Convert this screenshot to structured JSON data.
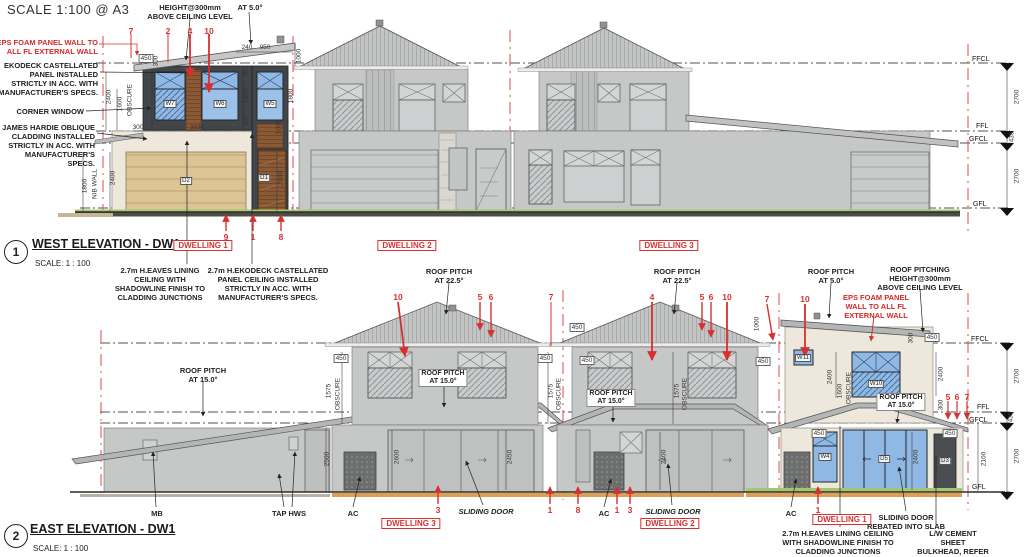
{
  "header": {
    "scale_note": "SCALE 1:100  @ A3"
  },
  "colors": {
    "annotation_red": "#d63030",
    "window_blue": "#8fb9e4",
    "timber_brown": "#8a5a36",
    "garage_tan": "#dcc496",
    "wall_gray": "#c6c8c7",
    "wall_cream": "#ede8db",
    "panel_charcoal": "#42464a",
    "grass_green": "#a5c86e",
    "deck_orange": "#dd9f56"
  },
  "west": {
    "drawing_number": "1",
    "title": "WEST ELEVATION - DW1",
    "scale": "SCALE:  1 : 100",
    "annotations": [
      {
        "t": "HEIGHT@300mm\nABOVE CEILING LEVEL",
        "c": "note",
        "x": 190,
        "y": 3
      },
      {
        "t": "AT 5.0°",
        "c": "note",
        "x": 250,
        "y": 3
      },
      {
        "t": "7",
        "c": "red",
        "x": 131,
        "y": 26
      },
      {
        "t": "2",
        "c": "red",
        "x": 168,
        "y": 26
      },
      {
        "t": "4",
        "c": "red",
        "x": 190,
        "y": 26
      },
      {
        "t": "10",
        "c": "red",
        "x": 209,
        "y": 26
      },
      {
        "t": "EPS FOAM PANEL WALL TO\nALL FL EXTERNAL WALL",
        "c": "noteR red2",
        "x": 98,
        "y": 38
      },
      {
        "t": "EKODECK CASTELLATED\nPANEL INSTALLED\nSTRICTLY IN ACC. WITH\nMANUFACTURER'S SPECS.",
        "c": "noteR",
        "x": 98,
        "y": 61
      },
      {
        "t": "CORNER WINDOW",
        "c": "noteR",
        "x": 84,
        "y": 107
      },
      {
        "t": "JAMES HARDIE OBLIQUE\nCLADDING INSTALLED\nSTRICTLY IN ACC. WITH\nMANUFACTURER'S\nSPECS.",
        "c": "noteR",
        "x": 95,
        "y": 123
      },
      {
        "t": "450",
        "c": "dimbox",
        "x": 146,
        "y": 54
      },
      {
        "t": "300",
        "c": "dimv",
        "x": 156,
        "y": 61
      },
      {
        "t": "240",
        "c": "dim",
        "x": 247,
        "y": 44
      },
      {
        "t": "950",
        "c": "dim",
        "x": 265,
        "y": 44
      },
      {
        "t": "1000",
        "c": "dimv",
        "x": 299,
        "y": 56
      },
      {
        "t": "2400",
        "c": "dimv",
        "x": 109,
        "y": 97
      },
      {
        "t": "1600",
        "c": "dimv",
        "x": 120,
        "y": 104
      },
      {
        "t": "OBSCURE",
        "c": "dimv",
        "x": 130,
        "y": 100
      },
      {
        "t": "300",
        "c": "dimv",
        "x": 246,
        "y": 71
      },
      {
        "t": "1800",
        "c": "dimv",
        "x": 246,
        "y": 96
      },
      {
        "t": "300",
        "c": "dimv",
        "x": 246,
        "y": 121
      },
      {
        "t": "1800",
        "c": "dimv",
        "x": 291,
        "y": 96
      },
      {
        "t": "1035",
        "c": "dimv",
        "x": 279,
        "y": 127
      },
      {
        "t": "300",
        "c": "dim",
        "x": 138,
        "y": 124
      },
      {
        "t": "3830",
        "c": "dim",
        "x": 197,
        "y": 124
      },
      {
        "t": "W7",
        "c": "wlbl",
        "x": 170,
        "y": 104
      },
      {
        "t": "W6",
        "c": "wlbl",
        "x": 220,
        "y": 104
      },
      {
        "t": "W5",
        "c": "wlbl",
        "x": 270,
        "y": 104
      },
      {
        "t": "D2",
        "c": "wlbl",
        "x": 186,
        "y": 181
      },
      {
        "t": "D1",
        "c": "wlbl",
        "x": 264,
        "y": 178
      },
      {
        "t": "2400",
        "c": "dimv",
        "x": 281,
        "y": 178
      },
      {
        "t": "1800",
        "c": "dimv",
        "x": 85,
        "y": 186
      },
      {
        "t": "NIB WALL",
        "c": "dimv",
        "x": 95,
        "y": 184
      },
      {
        "t": "2400",
        "c": "dimv",
        "x": 113,
        "y": 178
      },
      {
        "t": "9",
        "c": "red",
        "x": 226,
        "y": 232
      },
      {
        "t": "1",
        "c": "red",
        "x": 253,
        "y": 232
      },
      {
        "t": "8",
        "c": "red",
        "x": 281,
        "y": 232
      },
      {
        "t": "DWELLING 1",
        "c": "redbox",
        "x": 203,
        "y": 240
      },
      {
        "t": "DWELLING 2",
        "c": "redbox",
        "x": 407,
        "y": 240
      },
      {
        "t": "DWELLING 3",
        "c": "redbox",
        "x": 669,
        "y": 240
      },
      {
        "t": "2.7m H.EAVES LINING\nCEILING WITH\nSHADOWLINE FINISH TO\nCLADDING JUNCTIONS",
        "c": "note",
        "x": 160,
        "y": 266
      },
      {
        "t": "2.7m H.EKODECK CASTELLATED\nPANEL CEILING INSTALLED\nSTRICTLY IN ACC. WITH\nMANUFACTURER'S SPECS.",
        "c": "note",
        "x": 268,
        "y": 266
      },
      {
        "t": "FFCL",
        "c": "lvl",
        "x": 972,
        "y": 56
      },
      {
        "t": "FFL",
        "c": "lvl",
        "x": 976,
        "y": 123
      },
      {
        "t": "GFCL",
        "c": "lvl",
        "x": 969,
        "y": 136
      },
      {
        "t": "GFL",
        "c": "lvl",
        "x": 973,
        "y": 201
      },
      {
        "t": "2700",
        "c": "dimv",
        "x": 1017,
        "y": 97
      },
      {
        "t": "435",
        "c": "dimv",
        "x": 1012,
        "y": 137
      },
      {
        "t": "2700",
        "c": "dimv",
        "x": 1017,
        "y": 176
      }
    ]
  },
  "east": {
    "drawing_number": "2",
    "title": "EAST ELEVATION - DW1",
    "scale": "SCALE: 1 : 100",
    "annotations": [
      {
        "t": "ROOF PITCH\nAT 22.5°",
        "c": "note",
        "x": 449,
        "y": 267
      },
      {
        "t": "ROOF PITCH\nAT 22.5°",
        "c": "note",
        "x": 677,
        "y": 267
      },
      {
        "t": "ROOF PITCH\nAT 5.0°",
        "c": "note",
        "x": 831,
        "y": 267
      },
      {
        "t": "ROOF PITCHING\nHEIGHT@300mm\nABOVE CEILING LEVEL",
        "c": "note",
        "x": 920,
        "y": 265
      },
      {
        "t": "EPS FOAM PANEL\nWALL TO ALL FL\nEXTERNAL WALL",
        "c": "note red2",
        "x": 876,
        "y": 293
      },
      {
        "t": "ROOF PITCH\nAT 15.0°",
        "c": "note",
        "x": 203,
        "y": 366
      },
      {
        "t": "ROOF PITCH\nAT 15.0°",
        "c": "notebox",
        "x": 443,
        "y": 369
      },
      {
        "t": "ROOF PITCH\nAT 15.0°",
        "c": "notebox",
        "x": 611,
        "y": 389
      },
      {
        "t": "ROOF PITCH\nAT 15.0°",
        "c": "notebox",
        "x": 901,
        "y": 393
      },
      {
        "t": "10",
        "c": "red",
        "x": 398,
        "y": 292
      },
      {
        "t": "5",
        "c": "red",
        "x": 480,
        "y": 292
      },
      {
        "t": "6",
        "c": "red",
        "x": 491,
        "y": 292
      },
      {
        "t": "7",
        "c": "red",
        "x": 551,
        "y": 292
      },
      {
        "t": "4",
        "c": "red",
        "x": 652,
        "y": 292
      },
      {
        "t": "5",
        "c": "red",
        "x": 702,
        "y": 292
      },
      {
        "t": "6",
        "c": "red",
        "x": 711,
        "y": 292
      },
      {
        "t": "10",
        "c": "red",
        "x": 727,
        "y": 292
      },
      {
        "t": "7",
        "c": "red",
        "x": 767,
        "y": 294
      },
      {
        "t": "10",
        "c": "red",
        "x": 805,
        "y": 294
      },
      {
        "t": "5",
        "c": "red",
        "x": 948,
        "y": 392
      },
      {
        "t": "6",
        "c": "red",
        "x": 957,
        "y": 392
      },
      {
        "t": "7",
        "c": "red",
        "x": 967,
        "y": 392
      },
      {
        "t": "450",
        "c": "dimbox",
        "x": 341,
        "y": 354
      },
      {
        "t": "1575",
        "c": "dimv",
        "x": 329,
        "y": 391
      },
      {
        "t": "OBSCURE",
        "c": "dimv",
        "x": 338,
        "y": 394
      },
      {
        "t": "450",
        "c": "dimbox",
        "x": 545,
        "y": 354
      },
      {
        "t": "1575",
        "c": "dimv",
        "x": 551,
        "y": 391
      },
      {
        "t": "OBSCURE",
        "c": "dimv",
        "x": 559,
        "y": 394
      },
      {
        "t": "450",
        "c": "dimbox",
        "x": 577,
        "y": 323
      },
      {
        "t": "450",
        "c": "dimbox",
        "x": 587,
        "y": 356
      },
      {
        "t": "1575",
        "c": "dimv",
        "x": 677,
        "y": 391
      },
      {
        "t": "OBSCURE",
        "c": "dimv",
        "x": 685,
        "y": 394
      },
      {
        "t": "1000",
        "c": "dimv",
        "x": 757,
        "y": 324
      },
      {
        "t": "450",
        "c": "dimbox",
        "x": 763,
        "y": 357
      },
      {
        "t": "300",
        "c": "dimv",
        "x": 911,
        "y": 338
      },
      {
        "t": "450",
        "c": "dimbox",
        "x": 932,
        "y": 333
      },
      {
        "t": "2400",
        "c": "dimv",
        "x": 830,
        "y": 377
      },
      {
        "t": "1600",
        "c": "dimv",
        "x": 840,
        "y": 391
      },
      {
        "t": "OBSCURE",
        "c": "dimv",
        "x": 849,
        "y": 388
      },
      {
        "t": "2400",
        "c": "dimv",
        "x": 941,
        "y": 374
      },
      {
        "t": "300",
        "c": "dimv",
        "x": 941,
        "y": 405
      },
      {
        "t": "W11",
        "c": "wlbl",
        "x": 803,
        "y": 358
      },
      {
        "t": "W10",
        "c": "wlbl",
        "x": 876,
        "y": 384
      },
      {
        "t": "W4",
        "c": "wlbl",
        "x": 825,
        "y": 457
      },
      {
        "t": "D5",
        "c": "wlbl",
        "x": 884,
        "y": 459
      },
      {
        "t": "D3",
        "c": "wlbl",
        "x": 945,
        "y": 461
      },
      {
        "t": "450",
        "c": "dimbox",
        "x": 819,
        "y": 429
      },
      {
        "t": "450",
        "c": "dimbox",
        "x": 950,
        "y": 429
      },
      {
        "t": "2400",
        "c": "dimv",
        "x": 916,
        "y": 457
      },
      {
        "t": "2100",
        "c": "dimv",
        "x": 984,
        "y": 459
      },
      {
        "t": "2500",
        "c": "dimv",
        "x": 327,
        "y": 459
      },
      {
        "t": "2600",
        "c": "dimv",
        "x": 397,
        "y": 457
      },
      {
        "t": "2450",
        "c": "dimv",
        "x": 510,
        "y": 457
      },
      {
        "t": "2400",
        "c": "dimv",
        "x": 664,
        "y": 457
      },
      {
        "t": "FFCL",
        "c": "lvl",
        "x": 971,
        "y": 336
      },
      {
        "t": "FFL",
        "c": "lvl",
        "x": 977,
        "y": 404
      },
      {
        "t": "GFCL",
        "c": "lvl",
        "x": 969,
        "y": 417
      },
      {
        "t": "GFL",
        "c": "lvl",
        "x": 972,
        "y": 484
      },
      {
        "t": "2700",
        "c": "dimv",
        "x": 1017,
        "y": 376
      },
      {
        "t": "435",
        "c": "dimv",
        "x": 1011,
        "y": 417
      },
      {
        "t": "2700",
        "c": "dimv",
        "x": 1017,
        "y": 456
      },
      {
        "t": "MB",
        "c": "note",
        "x": 157,
        "y": 509
      },
      {
        "t": "TAP HWS",
        "c": "note",
        "x": 289,
        "y": 509
      },
      {
        "t": "AC",
        "c": "note",
        "x": 353,
        "y": 509
      },
      {
        "t": "3",
        "c": "red",
        "x": 438,
        "y": 505
      },
      {
        "t": "SLIDING DOOR",
        "c": "ital",
        "x": 486,
        "y": 507
      },
      {
        "t": "1",
        "c": "red",
        "x": 550,
        "y": 505
      },
      {
        "t": "8",
        "c": "red",
        "x": 578,
        "y": 505
      },
      {
        "t": "AC",
        "c": "note",
        "x": 604,
        "y": 509
      },
      {
        "t": "1",
        "c": "red",
        "x": 617,
        "y": 505
      },
      {
        "t": "3",
        "c": "red",
        "x": 630,
        "y": 505
      },
      {
        "t": "SLIDING DOOR",
        "c": "ital",
        "x": 673,
        "y": 507
      },
      {
        "t": "AC",
        "c": "note",
        "x": 791,
        "y": 509
      },
      {
        "t": "1",
        "c": "red",
        "x": 818,
        "y": 505
      },
      {
        "t": "DWELLING 3",
        "c": "redbox",
        "x": 411,
        "y": 518
      },
      {
        "t": "DWELLING 2",
        "c": "redbox",
        "x": 670,
        "y": 518
      },
      {
        "t": "DWELLING 1",
        "c": "redbox",
        "x": 842,
        "y": 514
      },
      {
        "t": "SLIDING DOOR\nREBATED INTO SLAB",
        "c": "note",
        "x": 906,
        "y": 513
      },
      {
        "t": "2.7m H.EAVES LINING CEILING\nWITH SHADOWLINE FINISH TO\nCLADDING JUNCTIONS",
        "c": "note",
        "x": 838,
        "y": 529
      },
      {
        "t": "L/W CEMENT SHEET\nBULKHEAD, REFER TO\nPLAN & DETAIL",
        "c": "note",
        "x": 953,
        "y": 529
      }
    ]
  }
}
